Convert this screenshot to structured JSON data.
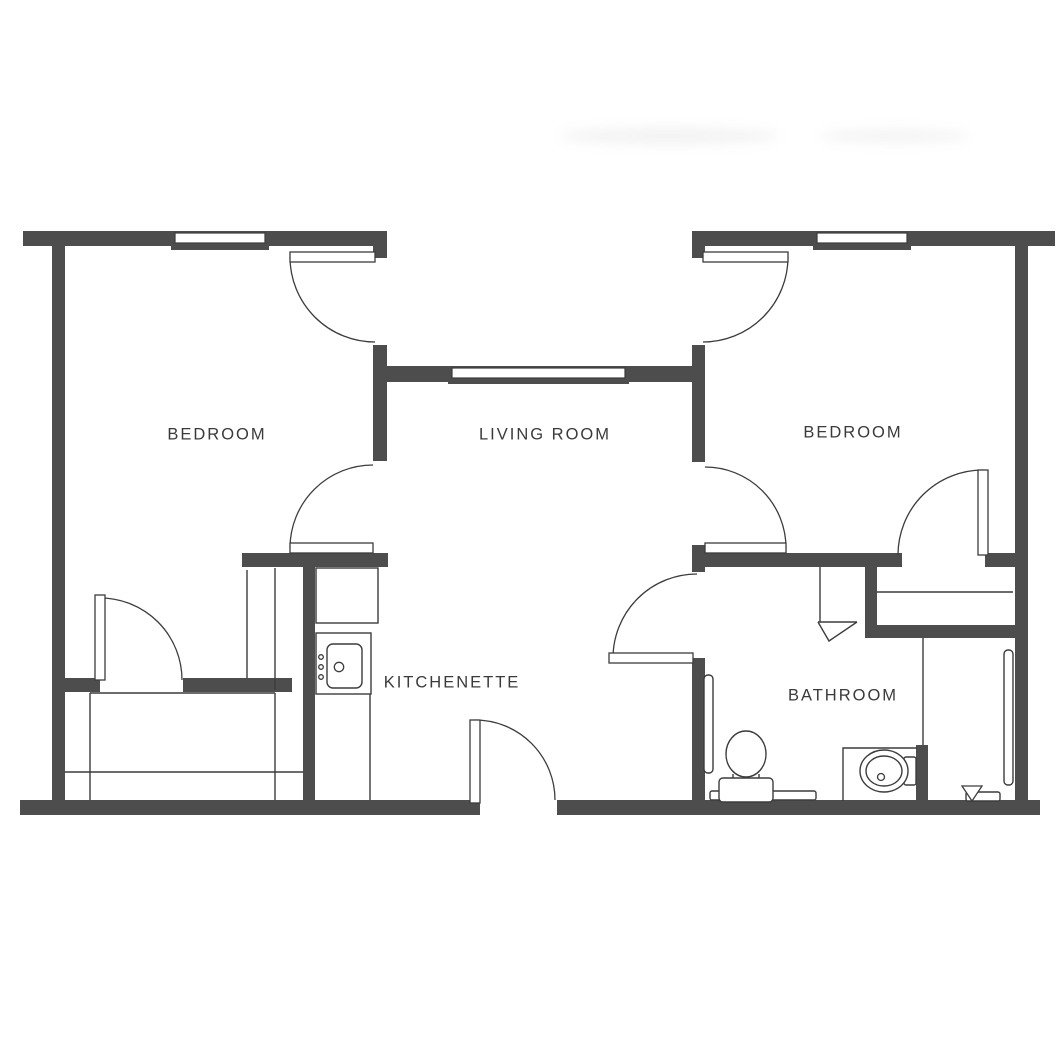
{
  "plan": {
    "title": "Two-bedroom apartment floor plan",
    "canvas": {
      "width": 1064,
      "height": 1064,
      "background": "#ffffff"
    },
    "colors": {
      "wall": "#4d4d4d",
      "line": "#3c3c3c",
      "label": "#3a3a3a",
      "leaf_fill": "#ffffff"
    },
    "rooms": [
      {
        "id": "bedroom-left",
        "label": "BEDROOM",
        "x": 217,
        "y": 435
      },
      {
        "id": "living-room",
        "label": "LIVING ROOM",
        "x": 545,
        "y": 435
      },
      {
        "id": "bedroom-right",
        "label": "BEDROOM",
        "x": 853,
        "y": 433
      },
      {
        "id": "kitchenette",
        "label": "KITCHENETTE",
        "x": 452,
        "y": 683
      },
      {
        "id": "bathroom",
        "label": "BATHROOM",
        "x": 843,
        "y": 696
      }
    ],
    "walls": [
      {
        "name": "outer-wall-top-left",
        "x": 23,
        "y": 231,
        "w": 364,
        "h": 15
      },
      {
        "name": "outer-wall-top-right",
        "x": 692,
        "y": 231,
        "w": 363,
        "h": 15
      },
      {
        "name": "outer-wall-left",
        "x": 52,
        "y": 246,
        "w": 13,
        "h": 557
      },
      {
        "name": "outer-wall-right",
        "x": 1015,
        "y": 246,
        "w": 13,
        "h": 557
      },
      {
        "name": "outer-wall-bottom-left",
        "x": 20,
        "y": 800,
        "w": 460,
        "h": 15
      },
      {
        "name": "outer-wall-bottom-right",
        "x": 557,
        "y": 800,
        "w": 483,
        "h": 15
      },
      {
        "name": "living-room-front-wall",
        "x": 387,
        "y": 366,
        "w": 306,
        "h": 16
      },
      {
        "name": "divider-left-upper",
        "x": 373,
        "y": 345,
        "w": 14,
        "h": 116
      },
      {
        "name": "door-jamb-left",
        "x": 373,
        "y": 245,
        "w": 14,
        "h": 13
      },
      {
        "name": "bedroom-left-bottom-wall",
        "x": 242,
        "y": 553,
        "w": 146,
        "h": 14
      },
      {
        "name": "kitchenette-wall",
        "x": 303,
        "y": 553,
        "w": 12,
        "h": 250
      },
      {
        "name": "closet-zone-wall-stub",
        "x": 52,
        "y": 678,
        "w": 48,
        "h": 14
      },
      {
        "name": "closet-zone-wall",
        "x": 183,
        "y": 678,
        "w": 109,
        "h": 14
      },
      {
        "name": "divider-right-upper",
        "x": 692,
        "y": 345,
        "w": 13,
        "h": 117
      },
      {
        "name": "door-jamb-right",
        "x": 692,
        "y": 245,
        "w": 13,
        "h": 13
      },
      {
        "name": "divider-right-middle",
        "x": 692,
        "y": 545,
        "w": 13,
        "h": 27
      },
      {
        "name": "bedroom-right-bottom-wall",
        "x": 705,
        "y": 553,
        "w": 197,
        "h": 14
      },
      {
        "name": "bedroom-right-bottom-wall-end",
        "x": 985,
        "y": 553,
        "w": 30,
        "h": 14
      },
      {
        "name": "bathroom-west-wall",
        "x": 692,
        "y": 658,
        "w": 13,
        "h": 145
      },
      {
        "name": "closet-right-west-wall",
        "x": 865,
        "y": 567,
        "w": 12,
        "h": 70
      },
      {
        "name": "closet-right-bottom-wall",
        "x": 865,
        "y": 625,
        "w": 152,
        "h": 13
      },
      {
        "name": "vanity-partition-stub",
        "x": 916,
        "y": 745,
        "w": 12,
        "h": 58
      }
    ],
    "windows": [
      {
        "name": "bedroom-left-window",
        "band": {
          "x": 175,
          "y": 233,
          "w": 90,
          "h": 10
        },
        "sill": {
          "x": 171,
          "y": 244,
          "w": 98,
          "h": 6
        }
      },
      {
        "name": "bedroom-right-window",
        "band": {
          "x": 817,
          "y": 233,
          "w": 90,
          "h": 10
        },
        "sill": {
          "x": 813,
          "y": 244,
          "w": 98,
          "h": 6
        }
      },
      {
        "name": "living-room-window",
        "band": {
          "x": 452,
          "y": 368,
          "w": 173,
          "h": 10
        },
        "sill": {
          "x": 448,
          "y": 378,
          "w": 181,
          "h": 6
        }
      }
    ],
    "doors": [
      {
        "name": "bedroom-left-entry-door",
        "leaf": {
          "x": 290,
          "y": 252,
          "w": 85,
          "h": 10
        },
        "arc": {
          "cx": 375,
          "cy": 257,
          "r": 85,
          "a1": 180,
          "a2": 90,
          "sweep": 0
        }
      },
      {
        "name": "bedroom-right-entry-door",
        "leaf": {
          "x": 703,
          "y": 252,
          "w": 85,
          "h": 10
        },
        "arc": {
          "cx": 703,
          "cy": 257,
          "r": 85,
          "a1": 0,
          "a2": 90,
          "sweep": 1
        }
      },
      {
        "name": "living-to-bedroom-left-door",
        "leaf": {
          "x": 290,
          "y": 543,
          "w": 83,
          "h": 10
        },
        "arc": {
          "cx": 373,
          "cy": 548,
          "r": 83,
          "a1": 270,
          "a2": 180,
          "sweep": 0
        }
      },
      {
        "name": "living-to-bedroom-right-door",
        "leaf": {
          "x": 705,
          "y": 543,
          "w": 81,
          "h": 10
        },
        "arc": {
          "cx": 705,
          "cy": 548,
          "r": 81,
          "a1": 270,
          "a2": 0,
          "sweep": 1
        }
      },
      {
        "name": "bedroom-right-closet-door",
        "leaf": {
          "x": 978,
          "y": 470,
          "w": 10,
          "h": 85
        },
        "arc": {
          "cx": 983,
          "cy": 555,
          "r": 85,
          "a1": 270,
          "a2": 180,
          "sweep": 0
        }
      },
      {
        "name": "bedroom-left-closet-door",
        "leaf": {
          "x": 95,
          "y": 595,
          "w": 10,
          "h": 85
        },
        "arc": {
          "cx": 100,
          "cy": 680,
          "r": 82,
          "a1": 270,
          "a2": 0,
          "sweep": 1
        }
      },
      {
        "name": "main-entry-door",
        "leaf": {
          "x": 470,
          "y": 720,
          "w": 10,
          "h": 83
        },
        "arc": {
          "cx": 475,
          "cy": 800,
          "r": 80,
          "a1": 270,
          "a2": 0,
          "sweep": 1
        }
      },
      {
        "name": "bathroom-door",
        "leaf": {
          "x": 609,
          "y": 653,
          "w": 84,
          "h": 10
        },
        "arc": {
          "cx": 697,
          "cy": 658,
          "r": 84,
          "a1": 270,
          "a2": 180,
          "sweep": 0
        }
      }
    ],
    "thin_lines": [
      {
        "name": "closet-nook-line-a",
        "x1": 247,
        "y1": 570,
        "x2": 247,
        "y2": 678
      },
      {
        "name": "closet-nook-line-b",
        "x1": 275,
        "y1": 568,
        "x2": 275,
        "y2": 690
      },
      {
        "name": "closet-shelf-top",
        "x1": 90,
        "y1": 693,
        "x2": 275,
        "y2": 693
      },
      {
        "name": "closet-rod-left",
        "x1": 65,
        "y1": 772,
        "x2": 303,
        "y2": 772
      },
      {
        "name": "closet-side-a",
        "x1": 90,
        "y1": 693,
        "x2": 90,
        "y2": 800
      },
      {
        "name": "closet-side-b",
        "x1": 275,
        "y1": 693,
        "x2": 275,
        "y2": 800
      },
      {
        "name": "kitchen-counter-front",
        "x1": 370,
        "y1": 694,
        "x2": 370,
        "y2": 800
      },
      {
        "name": "refrigerator-door-line",
        "x1": 371,
        "y1": 570,
        "x2": 371,
        "y2": 622
      },
      {
        "name": "closet-rod-right",
        "x1": 877,
        "y1": 592,
        "x2": 1013,
        "y2": 592
      },
      {
        "name": "vanity-partition-line",
        "x1": 923,
        "y1": 638,
        "x2": 923,
        "y2": 745
      },
      {
        "name": "linen-nook-line",
        "x1": 820,
        "y1": 567,
        "x2": 820,
        "y2": 622
      },
      {
        "name": "linen-nook-bottom",
        "x1": 818,
        "y1": 622,
        "x2": 857,
        "y2": 622
      },
      {
        "name": "toilet-base-line",
        "x1": 723,
        "y1": 784,
        "x2": 769,
        "y2": 784
      },
      {
        "name": "toilet-stem-a",
        "x1": 733,
        "y1": 774,
        "x2": 733,
        "y2": 779
      },
      {
        "name": "toilet-stem-b",
        "x1": 759,
        "y1": 774,
        "x2": 759,
        "y2": 779
      }
    ],
    "thin_rects": [
      {
        "name": "refrigerator",
        "x": 316,
        "y": 568,
        "w": 62,
        "h": 55,
        "rx": 0
      },
      {
        "name": "kitchen-sink-unit",
        "x": 316,
        "y": 633,
        "w": 55,
        "h": 61,
        "rx": 0
      },
      {
        "name": "kitchen-sink-basin",
        "x": 327,
        "y": 644,
        "w": 35,
        "h": 44,
        "rx": 6
      },
      {
        "name": "towel-bar-left",
        "x": 704,
        "y": 675,
        "w": 9,
        "h": 98,
        "rx": 4
      },
      {
        "name": "towel-bar-right",
        "x": 1004,
        "y": 650,
        "w": 9,
        "h": 135,
        "rx": 4
      },
      {
        "name": "bath-mat",
        "x": 710,
        "y": 791,
        "w": 106,
        "h": 9,
        "rx": 2
      },
      {
        "name": "toilet-tank",
        "x": 719,
        "y": 778,
        "w": 54,
        "h": 24,
        "rx": 4
      },
      {
        "name": "toilet-paper-holder",
        "x": 966,
        "y": 792,
        "w": 34,
        "h": 9,
        "rx": 2
      },
      {
        "name": "soap-dish",
        "x": 904,
        "y": 757,
        "w": 12,
        "h": 28,
        "rx": 2
      }
    ],
    "ellipses": [
      {
        "name": "toilet-bowl",
        "cx": 746,
        "cy": 754,
        "rx": 20,
        "ry": 23
      },
      {
        "name": "bathroom-sink-outer",
        "cx": 884,
        "cy": 771,
        "rx": 24,
        "ry": 21
      },
      {
        "name": "bathroom-sink-inner",
        "cx": 884,
        "cy": 771,
        "rx": 18,
        "ry": 15
      }
    ],
    "circles": [
      {
        "name": "kitchen-sink-drain",
        "cx": 339,
        "cy": 667,
        "r": 4.7
      },
      {
        "name": "stove-knob-1",
        "cx": 321,
        "cy": 657,
        "r": 2.3
      },
      {
        "name": "stove-knob-2",
        "cx": 321,
        "cy": 667,
        "r": 2.3
      },
      {
        "name": "stove-knob-3",
        "cx": 321,
        "cy": 677,
        "r": 2.3
      },
      {
        "name": "bathroom-sink-drain",
        "cx": 881,
        "cy": 777,
        "r": 3.5
      }
    ],
    "polylines": [
      {
        "name": "vanity-counter-edge",
        "points": "843,801 843,748 917,748"
      },
      {
        "name": "linen-nook-flap",
        "points": "818,622 829,641 857,622"
      }
    ],
    "polygons": [
      {
        "name": "toilet-paper-roller",
        "points": "962,786 982,786 972,801"
      }
    ]
  }
}
